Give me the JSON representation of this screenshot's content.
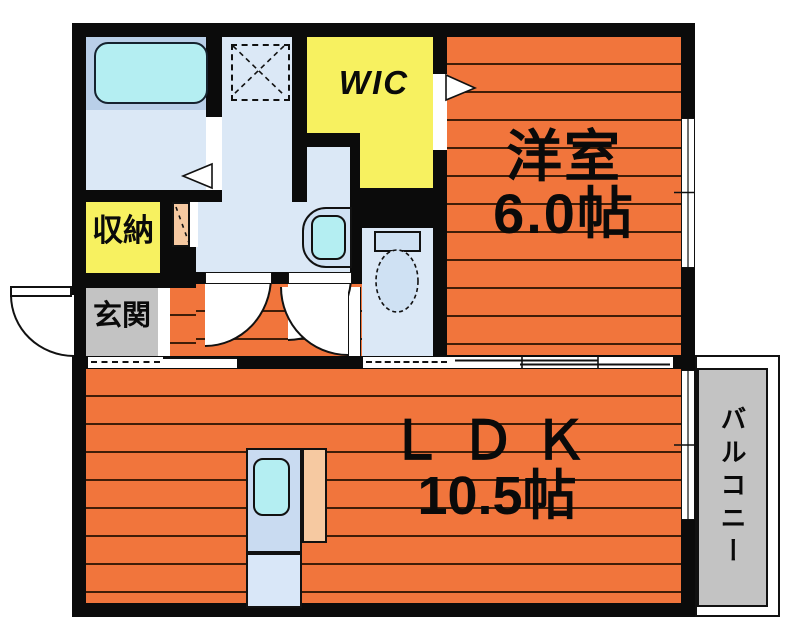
{
  "plan_type": "apartment-floor-plan",
  "rooms": {
    "bedroom": {
      "label": "洋室",
      "size": "6.0帖"
    },
    "ldk": {
      "label": "ＬＤＫ",
      "size": "10.5帖"
    },
    "wic": {
      "label": "WIC"
    },
    "storage": {
      "label": "収納"
    },
    "entrance": {
      "label": "玄関"
    },
    "balcony": {
      "label": "バルコニー"
    }
  },
  "colors": {
    "orange": "#f1753c",
    "floor_line": "#401d08",
    "yellow": "#f7f160",
    "wall": "#0b0b0b",
    "blue_light": "#dbe8f6",
    "blue_mid": "#b9cfe8",
    "cyan": "#b4eef2",
    "gray": "#c3c3c3",
    "kitchen_blue": "#c9dbf1",
    "kitchen_blue_light": "#d9e7f8",
    "peach": "#f6c9a1",
    "tank_fill": "#cfe1f3"
  }
}
